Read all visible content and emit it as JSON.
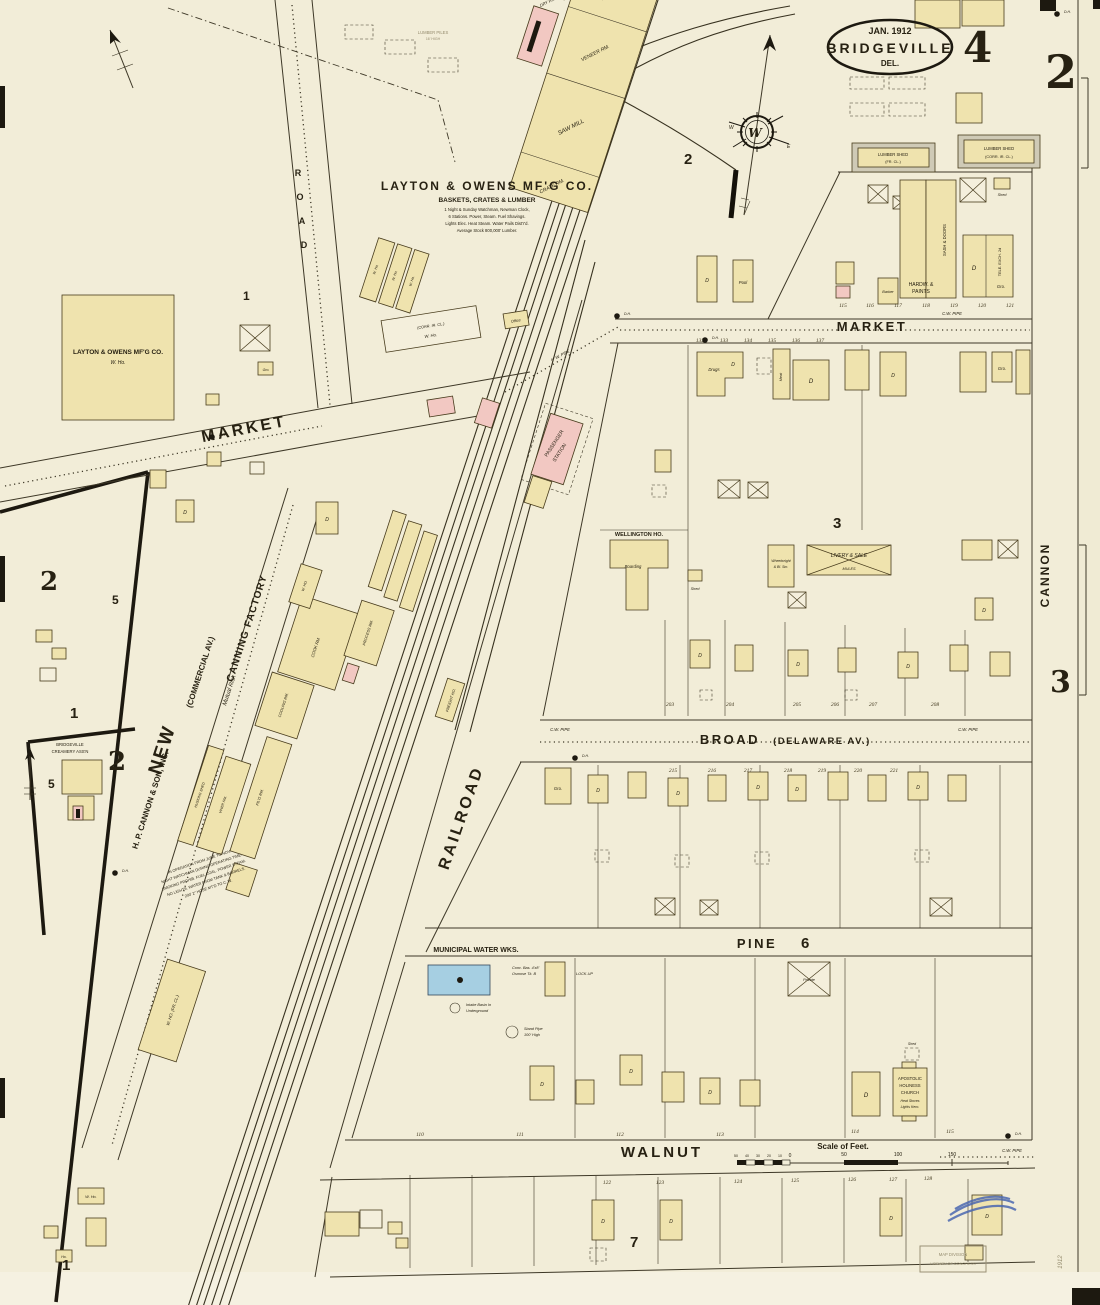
{
  "palette": {
    "paper": "#f2edd8",
    "building_yellow": "#efe3ae",
    "building_pink": "#f2c8c2",
    "building_blue": "#a6cfe2",
    "shed_gray": "#cfcab6",
    "ink": "#272112",
    "stamp_blue": "#4a66b0"
  },
  "title": {
    "date": "JAN. 1912",
    "city": "BRIDGEVILLE",
    "state": "DEL.",
    "sheet": "4"
  },
  "refs": {
    "top_right": "2",
    "right": "3",
    "west_upper": "2",
    "west_creamery": "2"
  },
  "blocks": {
    "top": "1",
    "compass": "2",
    "three": "3",
    "west_five": "5",
    "creamery_five": "5",
    "west_one": "1",
    "six": "6",
    "seven": "7",
    "bottom_one": "1"
  },
  "compass": {
    "w": "W",
    "e": "E"
  },
  "streets": {
    "market_left": "MARKET",
    "market_right": "MARKET",
    "road": [
      "R",
      "O",
      "A",
      "D"
    ],
    "broad1": "BROAD",
    "broad2": "(DELAWARE  AV.)",
    "pine": "PINE",
    "walnut": "WALNUT",
    "cannon": "CANNON",
    "railroad": "RAILROAD",
    "new_name": "NEW",
    "new_paren": "(COMMERCIAL  AV.)",
    "hp": "H. P. CANNON & SON, INC.",
    "canning": "CANNING  FACTORY",
    "mutual": "Mutual Risk"
  },
  "landmarks": {
    "layton": {
      "name": "LAYTON  &  OWENS  MF'G  CO.",
      "sub": "BASKETS, CRATES & LUMBER",
      "wh_name": "LAYTON & OWENS MF'G CO.",
      "wh_sub": "W. Ho.",
      "piles": "LUMBER PILES",
      "piles2": "16' HIGH"
    },
    "mill": {
      "basket": "BASKET RM.",
      "veneer": "VENEER RM.",
      "saw": "SAW MILL",
      "crate": "CRATE RM.",
      "dry": "DRY RM."
    },
    "sheds": {
      "a1": "LUMBER SHED",
      "a2": "(FR. CL.)",
      "b1": "LUMBER SHED",
      "b2": "(CORR. IR. CL.)"
    },
    "station": {
      "l1": "PASSENGER",
      "l2": "STATION"
    },
    "freight": "FREIGHT HO.",
    "wellington": {
      "name": "WELLINGTON HO.",
      "boarding": "Boarding"
    },
    "livery": {
      "l1": "LIVERY & SALE",
      "l2": "MULES"
    },
    "wheelwright": {
      "l1": "Wheelwright",
      "l2": "& Bl. Sm."
    },
    "hardware": {
      "l1": "HARDW. &",
      "l2": "PAINTS",
      "sash": "SASH & DOORS",
      "tele": "TELE. EXCH. 2d",
      "corr": "(CORR. IR. CL.)"
    },
    "water": {
      "name": "MUNICIPAL WATER WKS.",
      "lockup": "LOCK-UP"
    },
    "church": {
      "l1": "APOSTOLIC",
      "l2": "HOLINESS",
      "l3": "CHURCH"
    },
    "creamery": {
      "l1": "BRIDGEVILLE",
      "l2": "CREAMERY ASS'N"
    },
    "canning": {
      "cook": "COOK RM.",
      "process": "PROCESS RM.",
      "cooling": "COOLING RM.",
      "husking": "HUSKING SHED",
      "viner": "VINER RM.",
      "filling": "FIL'G RM.",
      "wh": "W. HO.",
      "whfr": "W. HO. (FR. CL.)"
    }
  },
  "glyphs": {
    "d": "D",
    "gro": "Gro.",
    "shed": "Shed",
    "who": "W. Ho.",
    "office": "Office",
    "drugs": "Drugs",
    "barber": "Barber",
    "pool": "Pool",
    "dh": "D.H.",
    "ho": "Ho.",
    "meat": "Meat",
    "private": "Private"
  },
  "pipes": {
    "cw": "C.W. PIPE",
    "gw": "6\" W. PIPE"
  },
  "scale": {
    "title": "Scale of Feet.",
    "small": [
      "50",
      "40",
      "30",
      "20",
      "10",
      "0"
    ],
    "main": [
      "50",
      "100",
      "150"
    ]
  },
  "lots": {
    "market_north": [
      "115",
      "116",
      "117",
      "118",
      "119",
      "120",
      "121"
    ],
    "market_south": [
      "132",
      "133",
      "134",
      "135",
      "136",
      "137"
    ],
    "broad_north": [
      "203",
      "204",
      "205",
      "206",
      "207",
      "208"
    ],
    "broad_south": [
      "215",
      "216",
      "217",
      "218",
      "219",
      "220",
      "221"
    ],
    "walnut_north": [
      "110",
      "111",
      "112",
      "113",
      "114",
      "115"
    ],
    "walnut_south": [
      "122",
      "123",
      "124",
      "125",
      "126",
      "127",
      "128"
    ]
  },
  "notes": {
    "layton": [
      "1 Night & Sunday Watchman, Newman Clock,",
      "6 Stations. Power, Steam. Fuel Shavings.",
      "Lights Elec. Heat Steam. Water Pails Dist'r'd.",
      "Average Stock 800,000' Lumber."
    ],
    "operation": [
      "IN OPERATION FROM JUNE TO NOV.",
      "NIGHT WATCHMAN DURING OPERATING TIME.",
      "SMOKING PROHIB. FUEL COAL. POWER STEAM.",
      "NO LIGHTS. WATER FROM TANK & BARRELS.",
      "200' 2\" HOSE MT'D TO C. W."
    ],
    "water": {
      "conc": "Conc. Bas. 4'x8'",
      "osmose": "Osmose Tk. B",
      "intake1": "Intake Basin In",
      "intake2": "Underground",
      "sp1": "Stand Pipe",
      "sp2": "100' High"
    },
    "church": [
      "Heat Stoves",
      "Lights Kero."
    ]
  },
  "stamps": {
    "l1": "MAP DIVISION",
    "l2": "LIBRARY OF CONGRESS",
    "year": "1912"
  }
}
